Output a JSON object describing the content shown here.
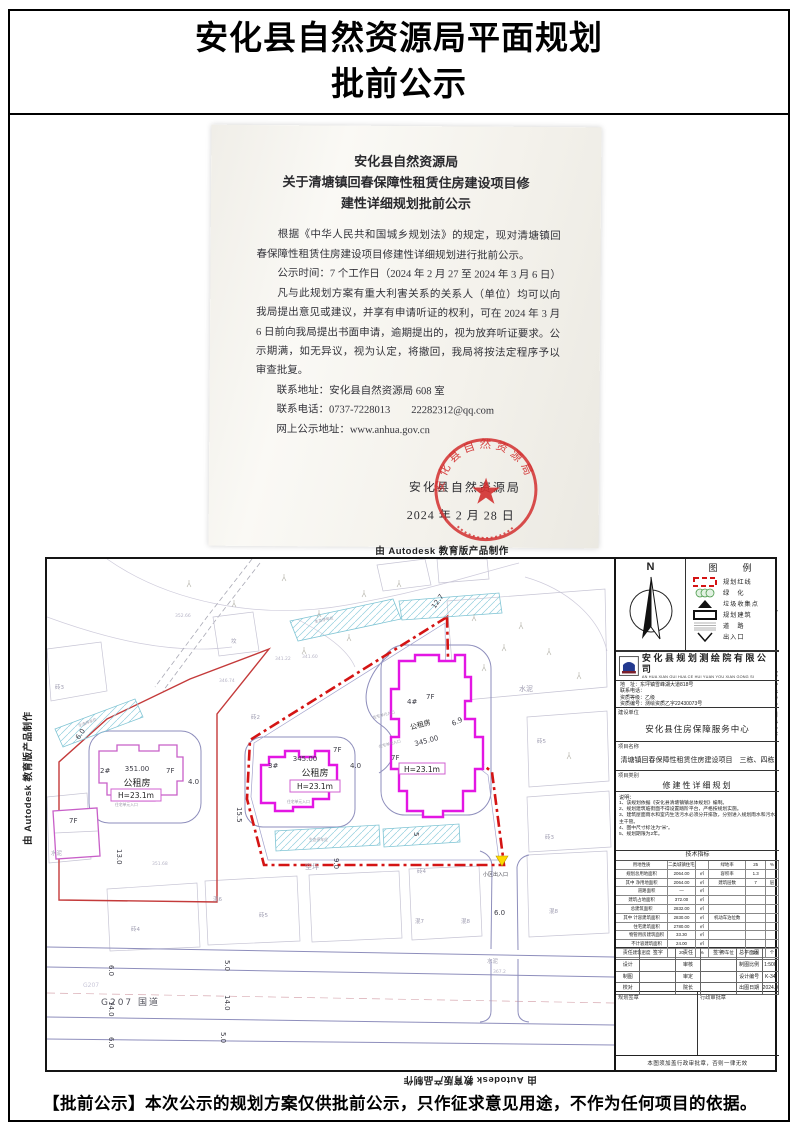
{
  "page": {
    "header_title_line1": "安化县自然资源局平面规划",
    "header_title_line2": "批前公示",
    "footer_notice": "【批前公示】本次公示的规划方案仅供批前公示，只作征求意见用途，不作为任何项目的依据。",
    "watermark_autodesk": "由 Autodesk 教育版产品制作"
  },
  "notice": {
    "title_line1": "安化县自然资源局",
    "title_line2": "关于清塘镇回春保障性租赁住房建设项目修",
    "title_line3": "建性详细规划批前公示",
    "p1": "根据《中华人民共和国城乡规划法》的规定，现对清塘镇回春保障性租赁住房建设项目修建性详细规划进行批前公示。",
    "p2": "公示时间：7 个工作日（2024 年 2 月 27 至 2024 年 3 月 6 日）",
    "p3": "凡与此规划方案有重大利害关系的关系人（单位）均可以向我局提出意见或建议，并享有申请听证的权利，可在 2024 年 3 月 6 日前向我局提出书面申请，逾期提出的，视为放弃听证要求。公示期满，如无异议，视为认定，将撤回，我局将按法定程序予以审查批复。",
    "contact_address": "联系地址：安化县自然资源局 608 室",
    "contact_phone": "联系电话：0737-7228013　　22282312@qq.com",
    "contact_web": "网上公示地址：www.anhua.gov.cn",
    "seal_ring_text": "安化县自然资源局",
    "seal_org": "安化县自然资源局",
    "seal_date": "2024 年 2 月 28 日",
    "seal_star": "★",
    "seal_color": "#d22f2f"
  },
  "map": {
    "buildings": {
      "b1": {
        "floors": "7F"
      },
      "b2": {
        "num": "2#",
        "area": "351.00",
        "floors": "7F",
        "name": "公租房",
        "height": "H=23.1m"
      },
      "b3": {
        "num": "3#",
        "area": "345.00",
        "floors": "7F",
        "name": "公租房",
        "height": "H=23.1m"
      },
      "b4": {
        "num": "4#",
        "area": "345.00",
        "floors": "7F",
        "name": "公租房",
        "height": "H=23.1m"
      }
    },
    "dims": {
      "d127": "12.7",
      "d69": "6.9",
      "d40": "4.0",
      "d155": "15.5",
      "d130": "13.0",
      "d90": "9.0",
      "d60": "6.0",
      "d5": "5",
      "d50": "5.0",
      "d140": "14.0"
    },
    "site": {
      "zhuan2": "砖2",
      "zhuan3": "砖3",
      "zhuan4": "砖4",
      "zhuan5": "砖5",
      "hun6": "混6",
      "hun7": "混7",
      "hun8": "混8",
      "kongping": "空坪",
      "shuini": "水泥",
      "grave": "坟",
      "g207": "G207 国道",
      "g207_small": "G207",
      "entrance": "小区出入口",
      "eco": "生态停车位",
      "unit_entrance": "住宅单元入口"
    },
    "elevations": {
      "e1": "352.66",
      "e2": "341.22",
      "e3": "346.74",
      "e4": "341.60",
      "e5": "351.68",
      "e6": "367.2"
    }
  },
  "panel": {
    "north_label": "N",
    "legend_title": "图　例",
    "legend": [
      {
        "label": "规划红线"
      },
      {
        "label": "绿　化"
      },
      {
        "label": "垃圾收集点"
      },
      {
        "label": "规划建筑"
      },
      {
        "label": "道　路"
      },
      {
        "label": "出入口"
      }
    ],
    "company_name": "安化县规划测绘院有限公司",
    "company_pinyin": "AN HUA XIAN GUI HUA CE HUI YUAN YOU XIAN GONG SI",
    "info_lines": [
      "地　址：东坪镇雪峰湖大道818号",
      "联系电话：",
      "资质等级：乙级",
      "资质编号：测绘资质乙字22430073号"
    ],
    "client_label": "建设单位",
    "client_value": "安化县住房保障服务中心",
    "project_label": "项目名称",
    "project_value": "清塘镇回春保障性租赁住房建设项目　三栋、四栋",
    "category_label": "项目类别",
    "category_value": "修建性详细规划",
    "notes_title": "说明：",
    "notes": [
      "1、该规划依据《安化县清塘镇镇总体规划》编制。",
      "2、规划建筑临街面不得设置踏阶平台，严格按规划实施。",
      "3、建筑屋面雨水和室内生活污水必须分开排放，分别进入规划雨水和污水主干管。",
      "4、图中尺寸标注为“米”。",
      "5、规划期限为2年。"
    ],
    "tech_title": "技术指标",
    "tech_rows": [
      [
        "用地性质",
        "二类城镇住宅用地",
        "",
        "绿地率",
        "25",
        "%"
      ],
      [
        "规划总用地面积",
        "2064.00",
        "㎡",
        "容积率",
        "1.3",
        ""
      ],
      [
        "其中 净用地面积",
        "2064.00",
        "㎡",
        "建筑层数",
        "7",
        "层"
      ],
      [
        "　　 道路面积",
        "—",
        "㎡",
        "",
        "",
        ""
      ],
      [
        "建筑占地面积",
        "372.00",
        "㎡",
        "",
        "",
        ""
      ],
      [
        "总建筑面积",
        "2832.00",
        "㎡",
        "",
        "",
        ""
      ],
      [
        "其中 计容建筑面积",
        "2830.00",
        "㎡",
        "机动车泊位数",
        "",
        ""
      ],
      [
        "　　 住宅建筑面积",
        "2780.00",
        "㎡",
        "",
        "",
        ""
      ],
      [
        "　　 物管用房建筑面积",
        "33.30",
        "㎡",
        "",
        "",
        ""
      ],
      [
        "　　 不计容建筑面积",
        "24.00",
        "㎡",
        "",
        "",
        ""
      ],
      [
        "建筑密度",
        "20",
        "%",
        "停车位",
        "20",
        "个"
      ]
    ],
    "sign_rows": [
      [
        "责任",
        "签字",
        "责任",
        "签字",
        "总平面图",
        ""
      ],
      [
        "设计",
        "",
        "审核",
        "",
        "制图比例",
        "1:500"
      ],
      [
        "制图",
        "",
        "审定",
        "",
        "设计编号",
        "K-34"
      ],
      [
        "校对",
        "",
        "院长",
        "",
        "出图日期",
        "2024.01"
      ]
    ],
    "stamp_left_label": "规划签章",
    "stamp_right_label": "行政审批章",
    "bottom_note": "本图须加盖行政审批章，否则一律无效"
  }
}
